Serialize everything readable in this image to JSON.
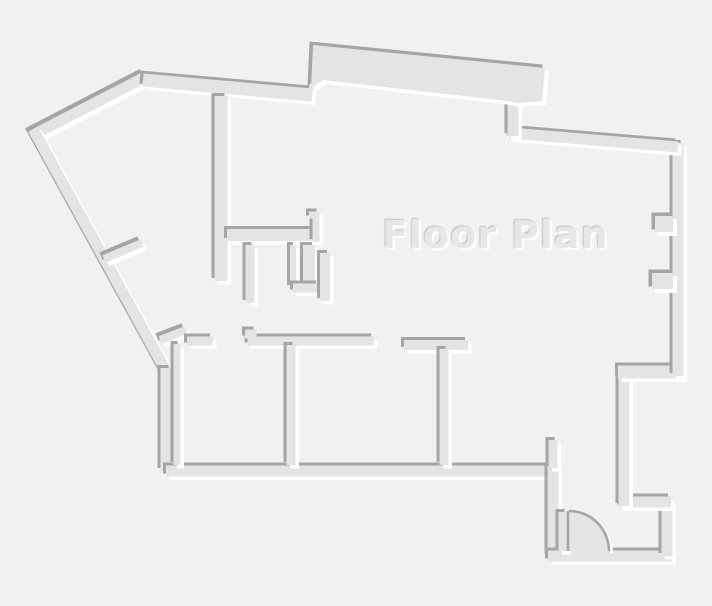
{
  "title": "Floor Plan",
  "canvas": {
    "width": 712,
    "height": 606,
    "background": "#f0f1f1"
  },
  "palette": {
    "wall_fill": "#e2e4e5",
    "edge_shadow": "#a3a5a6",
    "edge_highlight": "#ffffff",
    "title_color": "#e5e7e8",
    "title_shadow_dark": "#c2c4c5",
    "title_shadow_light": "#ffffff"
  },
  "emboss": {
    "shadow_offset": -3,
    "highlight_offset": 3.5
  },
  "walls": [
    {
      "name": "outer-left-upper-diagonal",
      "type": "line",
      "width": 11,
      "points": [
        [
          145,
          77
        ],
        [
          31,
          136
        ]
      ]
    },
    {
      "name": "outer-left-lower-diagonal",
      "type": "line",
      "width": 11,
      "points": [
        [
          33,
          129
        ],
        [
          166,
          371
        ]
      ]
    },
    {
      "name": "outer-left-wall",
      "type": "line",
      "width": 11,
      "points": [
        [
          166,
          368
        ],
        [
          166,
          471
        ]
      ]
    },
    {
      "name": "outer-bottom-wall",
      "type": "line",
      "width": 11,
      "points": [
        [
          166,
          471
        ],
        [
          553,
          471
        ]
      ]
    },
    {
      "name": "outer-entry-left-wall",
      "type": "line",
      "width": 11,
      "points": [
        [
          553,
          466
        ],
        [
          553,
          556
        ]
      ]
    },
    {
      "name": "outer-entry-bottom-wall",
      "type": "line",
      "width": 11,
      "points": [
        [
          548,
          556
        ],
        [
          672,
          556
        ]
      ]
    },
    {
      "name": "outer-entry-right-wall",
      "type": "line",
      "width": 11,
      "points": [
        [
          667,
          556
        ],
        [
          667,
          502
        ]
      ]
    },
    {
      "name": "outer-entry-jog",
      "type": "line",
      "width": 11,
      "points": [
        [
          671,
          502
        ],
        [
          620,
          502
        ]
      ]
    },
    {
      "name": "outer-right-lower-wall",
      "type": "line",
      "width": 11,
      "points": [
        [
          624,
          506
        ],
        [
          624,
          368
        ]
      ]
    },
    {
      "name": "outer-right-jog",
      "type": "line",
      "width": 13,
      "points": [
        [
          618,
          372
        ],
        [
          683,
          372
        ]
      ]
    },
    {
      "name": "outer-right-wall",
      "type": "line",
      "width": 11,
      "points": [
        [
          678,
          376
        ],
        [
          678,
          143
        ]
      ]
    },
    {
      "name": "outer-top-right-slant",
      "type": "line",
      "width": 11,
      "points": [
        [
          678,
          147
        ],
        [
          510,
          133
        ]
      ]
    },
    {
      "name": "outer-bump-connector",
      "type": "line",
      "width": 11,
      "points": [
        [
          513,
          136
        ],
        [
          513,
          99
        ]
      ]
    },
    {
      "name": "outer-top-wall",
      "type": "line",
      "width": 13,
      "points": [
        [
          143,
          80
        ],
        [
          312,
          95
        ]
      ]
    },
    {
      "name": "outer-top-bump-slab",
      "type": "poly",
      "width": 0,
      "points": [
        [
          313,
          45
        ],
        [
          545,
          68
        ],
        [
          542,
          101
        ],
        [
          517,
          103
        ],
        [
          508,
          101
        ],
        [
          323,
          80
        ],
        [
          311,
          88
        ]
      ]
    },
    {
      "name": "right-wall-pilaster-upper",
      "type": "poly",
      "width": 0,
      "points": [
        [
          655,
          216
        ],
        [
          673,
          216
        ],
        [
          673,
          232
        ],
        [
          655,
          232
        ]
      ]
    },
    {
      "name": "right-wall-pilaster-lower",
      "type": "poly",
      "width": 0,
      "points": [
        [
          652,
          273
        ],
        [
          673,
          273
        ],
        [
          673,
          289
        ],
        [
          652,
          289
        ]
      ]
    },
    {
      "name": "interior-top-shaft-wall",
      "type": "line",
      "width": 13,
      "points": [
        [
          221,
          96
        ],
        [
          221,
          281
        ]
      ]
    },
    {
      "name": "interior-upper-horizontal-wall",
      "type": "line",
      "width": 12,
      "points": [
        [
          227,
          235
        ],
        [
          317,
          235
        ]
      ]
    },
    {
      "name": "interior-upper-stub",
      "type": "line",
      "width": 7,
      "points": [
        [
          309,
          215
        ],
        [
          316,
          215
        ],
        [
          316,
          242
        ]
      ]
    },
    {
      "name": "interior-closet-stub-a",
      "type": "line",
      "width": 9,
      "points": [
        [
          250,
          245
        ],
        [
          250,
          303
        ]
      ]
    },
    {
      "name": "interior-closet-stub-b",
      "type": "line",
      "width": 6,
      "points": [
        [
          293,
          245
        ],
        [
          293,
          288
        ]
      ]
    },
    {
      "name": "interior-closet-thick-wall",
      "type": "line",
      "width": 12,
      "points": [
        [
          309,
          245
        ],
        [
          309,
          287
        ]
      ]
    },
    {
      "name": "interior-closet-foot",
      "type": "line",
      "width": 9,
      "points": [
        [
          293,
          288
        ],
        [
          319,
          288
        ]
      ]
    },
    {
      "name": "interior-closet-stub-c",
      "type": "line",
      "width": 10,
      "points": [
        [
          325,
          253
        ],
        [
          325,
          301
        ]
      ]
    },
    {
      "name": "interior-diagonal-stub-upper",
      "type": "line",
      "width": 8,
      "points": [
        [
          104,
          259
        ],
        [
          142,
          243
        ]
      ]
    },
    {
      "name": "interior-diagonal-stub-lower",
      "type": "line",
      "width": 8,
      "points": [
        [
          160,
          340
        ],
        [
          186,
          330
        ]
      ]
    },
    {
      "name": "interior-room1-top-wall",
      "type": "line",
      "width": 9,
      "points": [
        [
          187,
          341
        ],
        [
          213,
          341
        ]
      ]
    },
    {
      "name": "interior-room1-left-wall",
      "type": "line",
      "width": 7,
      "points": [
        [
          177,
          344
        ],
        [
          177,
          465
        ]
      ]
    },
    {
      "name": "interior-room2-top-wall",
      "type": "line",
      "width": 9,
      "points": [
        [
          245,
          334
        ],
        [
          252,
          334
        ],
        [
          252,
          341
        ],
        [
          374,
          341
        ]
      ]
    },
    {
      "name": "interior-room3-top-wall",
      "type": "line",
      "width": 10,
      "points": [
        [
          404,
          345
        ],
        [
          468,
          345
        ]
      ]
    },
    {
      "name": "interior-room-divider-1",
      "type": "line",
      "width": 9,
      "points": [
        [
          291,
          345
        ],
        [
          291,
          465
        ]
      ]
    },
    {
      "name": "interior-room-divider-2",
      "type": "line",
      "width": 9,
      "points": [
        [
          444,
          349
        ],
        [
          444,
          465
        ]
      ]
    },
    {
      "name": "interior-entry-stub",
      "type": "line",
      "width": 9,
      "points": [
        [
          553,
          440
        ],
        [
          553,
          468
        ]
      ]
    },
    {
      "name": "interior-door-jamb",
      "type": "line",
      "width": 9,
      "points": [
        [
          563,
          512
        ],
        [
          563,
          551
        ]
      ]
    }
  ],
  "door": {
    "name": "entry-door-swing",
    "hinge": [
      569,
      551
    ],
    "radius": 40,
    "leaf_top": [
      569,
      511
    ],
    "arc_end": [
      609,
      551
    ]
  }
}
